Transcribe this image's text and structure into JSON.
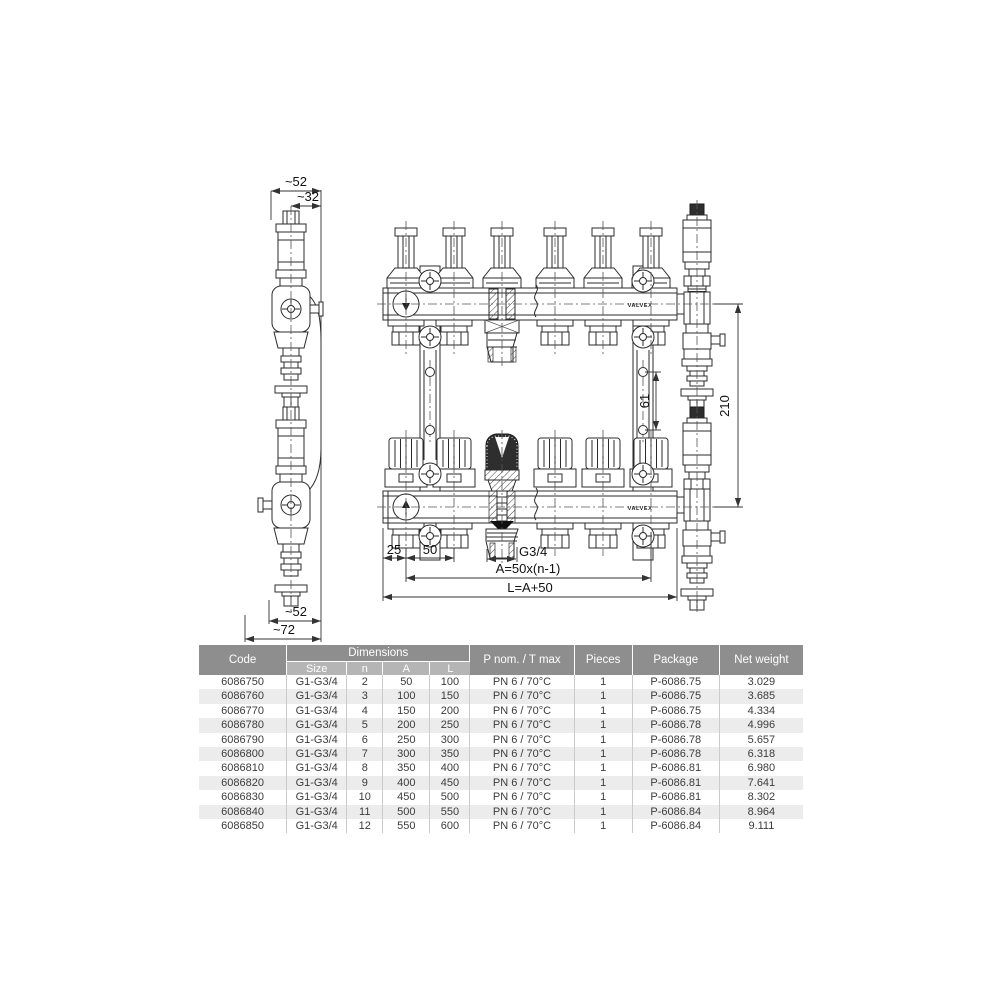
{
  "drawing": {
    "side_view": {
      "dim_top_width": "~52",
      "dim_top_offset": "~32",
      "dim_bottom_width": "~52",
      "dim_bottom_total": "~72"
    },
    "front_view": {
      "brand": "VALVEX",
      "dim_first_offset": "25",
      "dim_spacing": "50",
      "dim_outlet_thread": "G3/4",
      "dim_a_formula": "A=50x(n-1)",
      "dim_l_formula": "L=A+50",
      "dim_bracket_holes": "61",
      "dim_height": "210"
    }
  },
  "table": {
    "headers": {
      "code": "Code",
      "dimensions": "Dimensions",
      "size": "Size",
      "n": "n",
      "a": "A",
      "l": "L",
      "pnom": "P nom. / T max",
      "pieces": "Pieces",
      "package": "Package",
      "net_weight": "Net weight"
    },
    "rows": [
      [
        "6086750",
        "G1-G3/4",
        "2",
        "50",
        "100",
        "PN 6 / 70°C",
        "1",
        "P-6086.75",
        "3.029"
      ],
      [
        "6086760",
        "G1-G3/4",
        "3",
        "100",
        "150",
        "PN 6 / 70°C",
        "1",
        "P-6086.75",
        "3.685"
      ],
      [
        "6086770",
        "G1-G3/4",
        "4",
        "150",
        "200",
        "PN 6 / 70°C",
        "1",
        "P-6086.75",
        "4.334"
      ],
      [
        "6086780",
        "G1-G3/4",
        "5",
        "200",
        "250",
        "PN 6 / 70°C",
        "1",
        "P-6086.78",
        "4.996"
      ],
      [
        "6086790",
        "G1-G3/4",
        "6",
        "250",
        "300",
        "PN 6 / 70°C",
        "1",
        "P-6086.78",
        "5.657"
      ],
      [
        "6086800",
        "G1-G3/4",
        "7",
        "300",
        "350",
        "PN 6 / 70°C",
        "1",
        "P-6086.78",
        "6.318"
      ],
      [
        "6086810",
        "G1-G3/4",
        "8",
        "350",
        "400",
        "PN 6 / 70°C",
        "1",
        "P-6086.81",
        "6.980"
      ],
      [
        "6086820",
        "G1-G3/4",
        "9",
        "400",
        "450",
        "PN 6 / 70°C",
        "1",
        "P-6086.81",
        "7.641"
      ],
      [
        "6086830",
        "G1-G3/4",
        "10",
        "450",
        "500",
        "PN 6 / 70°C",
        "1",
        "P-6086.81",
        "8.302"
      ],
      [
        "6086840",
        "G1-G3/4",
        "11",
        "500",
        "550",
        "PN 6 / 70°C",
        "1",
        "P-6086.84",
        "8.964"
      ],
      [
        "6086850",
        "G1-G3/4",
        "12",
        "550",
        "600",
        "PN 6 / 70°C",
        "1",
        "P-6086.84",
        "9.111"
      ]
    ],
    "colors": {
      "header_bg": "#8e8e8e",
      "subheader_bg": "#b5b5b5",
      "row_stripe": "#ececec",
      "line_color": "#2b2b2b"
    }
  }
}
